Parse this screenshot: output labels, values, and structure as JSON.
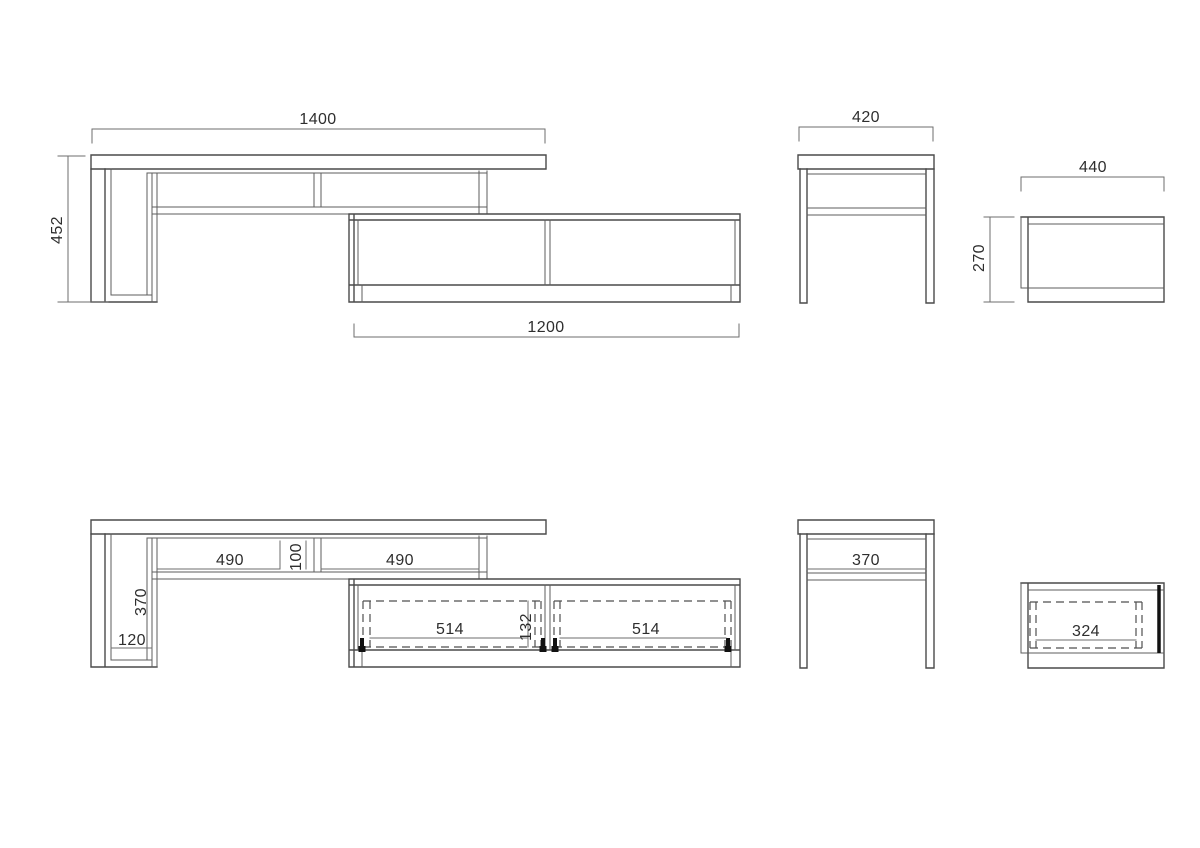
{
  "page": {
    "background": "#ffffff",
    "object_line_color": "#4a4a4a",
    "dimension_line_color": "#6e6e6e",
    "dashed_line_color": "#4f4f4f",
    "hinge_color": "#111111",
    "text_color": "#2e2e2e"
  },
  "views": {
    "front_top": {
      "dims": {
        "overall_width": "1400",
        "overall_height": "452",
        "lowboard_width": "1200"
      }
    },
    "side_top": {
      "dims": {
        "upper_depth": "420"
      }
    },
    "lowboard_side_top": {
      "dims": {
        "lowboard_depth": "440",
        "lowboard_height": "270"
      }
    },
    "front_bottom": {
      "dims": {
        "left_shelf_width": "490",
        "center_gap": "100",
        "right_shelf_width": "490",
        "leg_inner_height": "370",
        "leg_bottom": "120",
        "left_door_width": "514",
        "door_opening_height": "132",
        "right_door_width": "514"
      }
    },
    "side_bottom": {
      "dims": {
        "inner_width": "370"
      }
    },
    "lowboard_side_bottom": {
      "dims": {
        "inner_width": "324"
      }
    }
  }
}
